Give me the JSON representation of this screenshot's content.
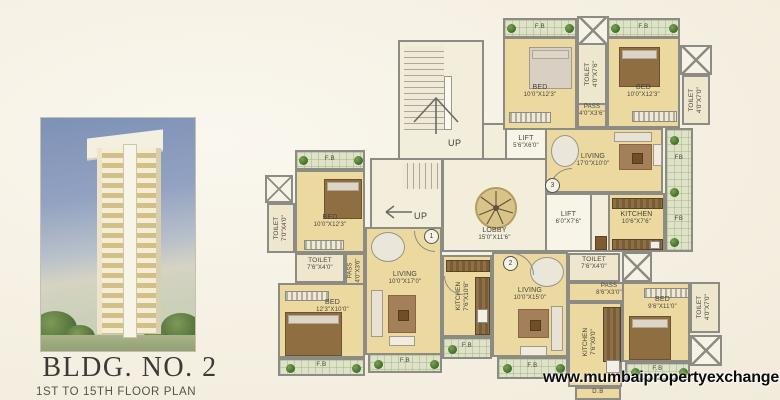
{
  "meta": {
    "watermark": "www.mumbaipropertyexchange.com"
  },
  "left_panel": {
    "title": "BLDG. NO. 2",
    "subtitle": "1ST TO 15TH FLOOR PLAN"
  },
  "labels": {
    "fb": "F.B",
    "fb_short": "FB",
    "db": "D.B",
    "up": "UP"
  },
  "flats": {
    "n1": "1",
    "n2": "2",
    "n3": "3"
  },
  "core": {
    "lobby_name": "LOBBY",
    "lobby_dims": "15'0\"X11'6\"",
    "lift_top_name": "LIFT",
    "lift_top_dims": "5'6\"X6'0\"",
    "lift_right_name": "LIFT",
    "lift_right_dims": "6'0\"X7'6\""
  },
  "unit3": {
    "bed1_name": "BED",
    "bed1_dims": "10'0\"X12'3\"",
    "toilet1_name": "TOILET",
    "toilet1_dims": "4'0\"X7'6\"",
    "bed2_name": "BED",
    "bed2_dims": "10'0\"X12'3\"",
    "toilet2_name": "TOILET",
    "toilet2_dims": "4'0\"X7'0\"",
    "pass_name": "PASS",
    "pass_dims": "4'0\"X3'6\"",
    "living_name": "LIVING",
    "living_dims": "17'0\"X10'0\"",
    "kitchen_name": "KITCHEN",
    "kitchen_dims": "10'6\"X7'6\""
  },
  "unit1": {
    "toilet1_name": "TOILET",
    "toilet1_dims": "7'0\"X4'0\"",
    "bed1_name": "BED",
    "bed1_dims": "10'0\"X12'3\"",
    "toilet2_name": "TOILET",
    "toilet2_dims": "7'6\"X4'0\"",
    "pass_name": "PASS",
    "pass_dims": "4'0\"X3'6\"",
    "living_name": "LIVING",
    "living_dims": "10'0\"X17'0\"",
    "bed2_name": "BED",
    "bed2_dims": "12'3\"X10'0\"",
    "kitchen_name": "KITCHEN",
    "kitchen_dims": "7'6\"X10'6\""
  },
  "unit2": {
    "living_name": "LIVING",
    "living_dims": "10'0\"X15'0\"",
    "toilet1_name": "TOILET",
    "toilet1_dims": "7'6\"X4'0\"",
    "pass_name": "PASS",
    "pass_dims": "8'6\"X3'0\"",
    "kitchen_name": "KITCHEN",
    "kitchen_dims": "7'6\"X9'0\"",
    "bed_name": "BED",
    "bed_dims": "9'6\"X11'0\"",
    "toilet2_name": "TOILET",
    "toilet2_dims": "4'0\"X7'0\""
  },
  "colors": {
    "room_fill": "#ecd9a0",
    "core_fill": "#f3eedb",
    "wall": "#8d8c84",
    "flower_bed_fill": "#dee3c8",
    "plant_green": "#4d7a33",
    "furniture_brown": "#8f6f42",
    "page_background": "#f5f0e2",
    "watermark_text": "#0c0c0c"
  }
}
